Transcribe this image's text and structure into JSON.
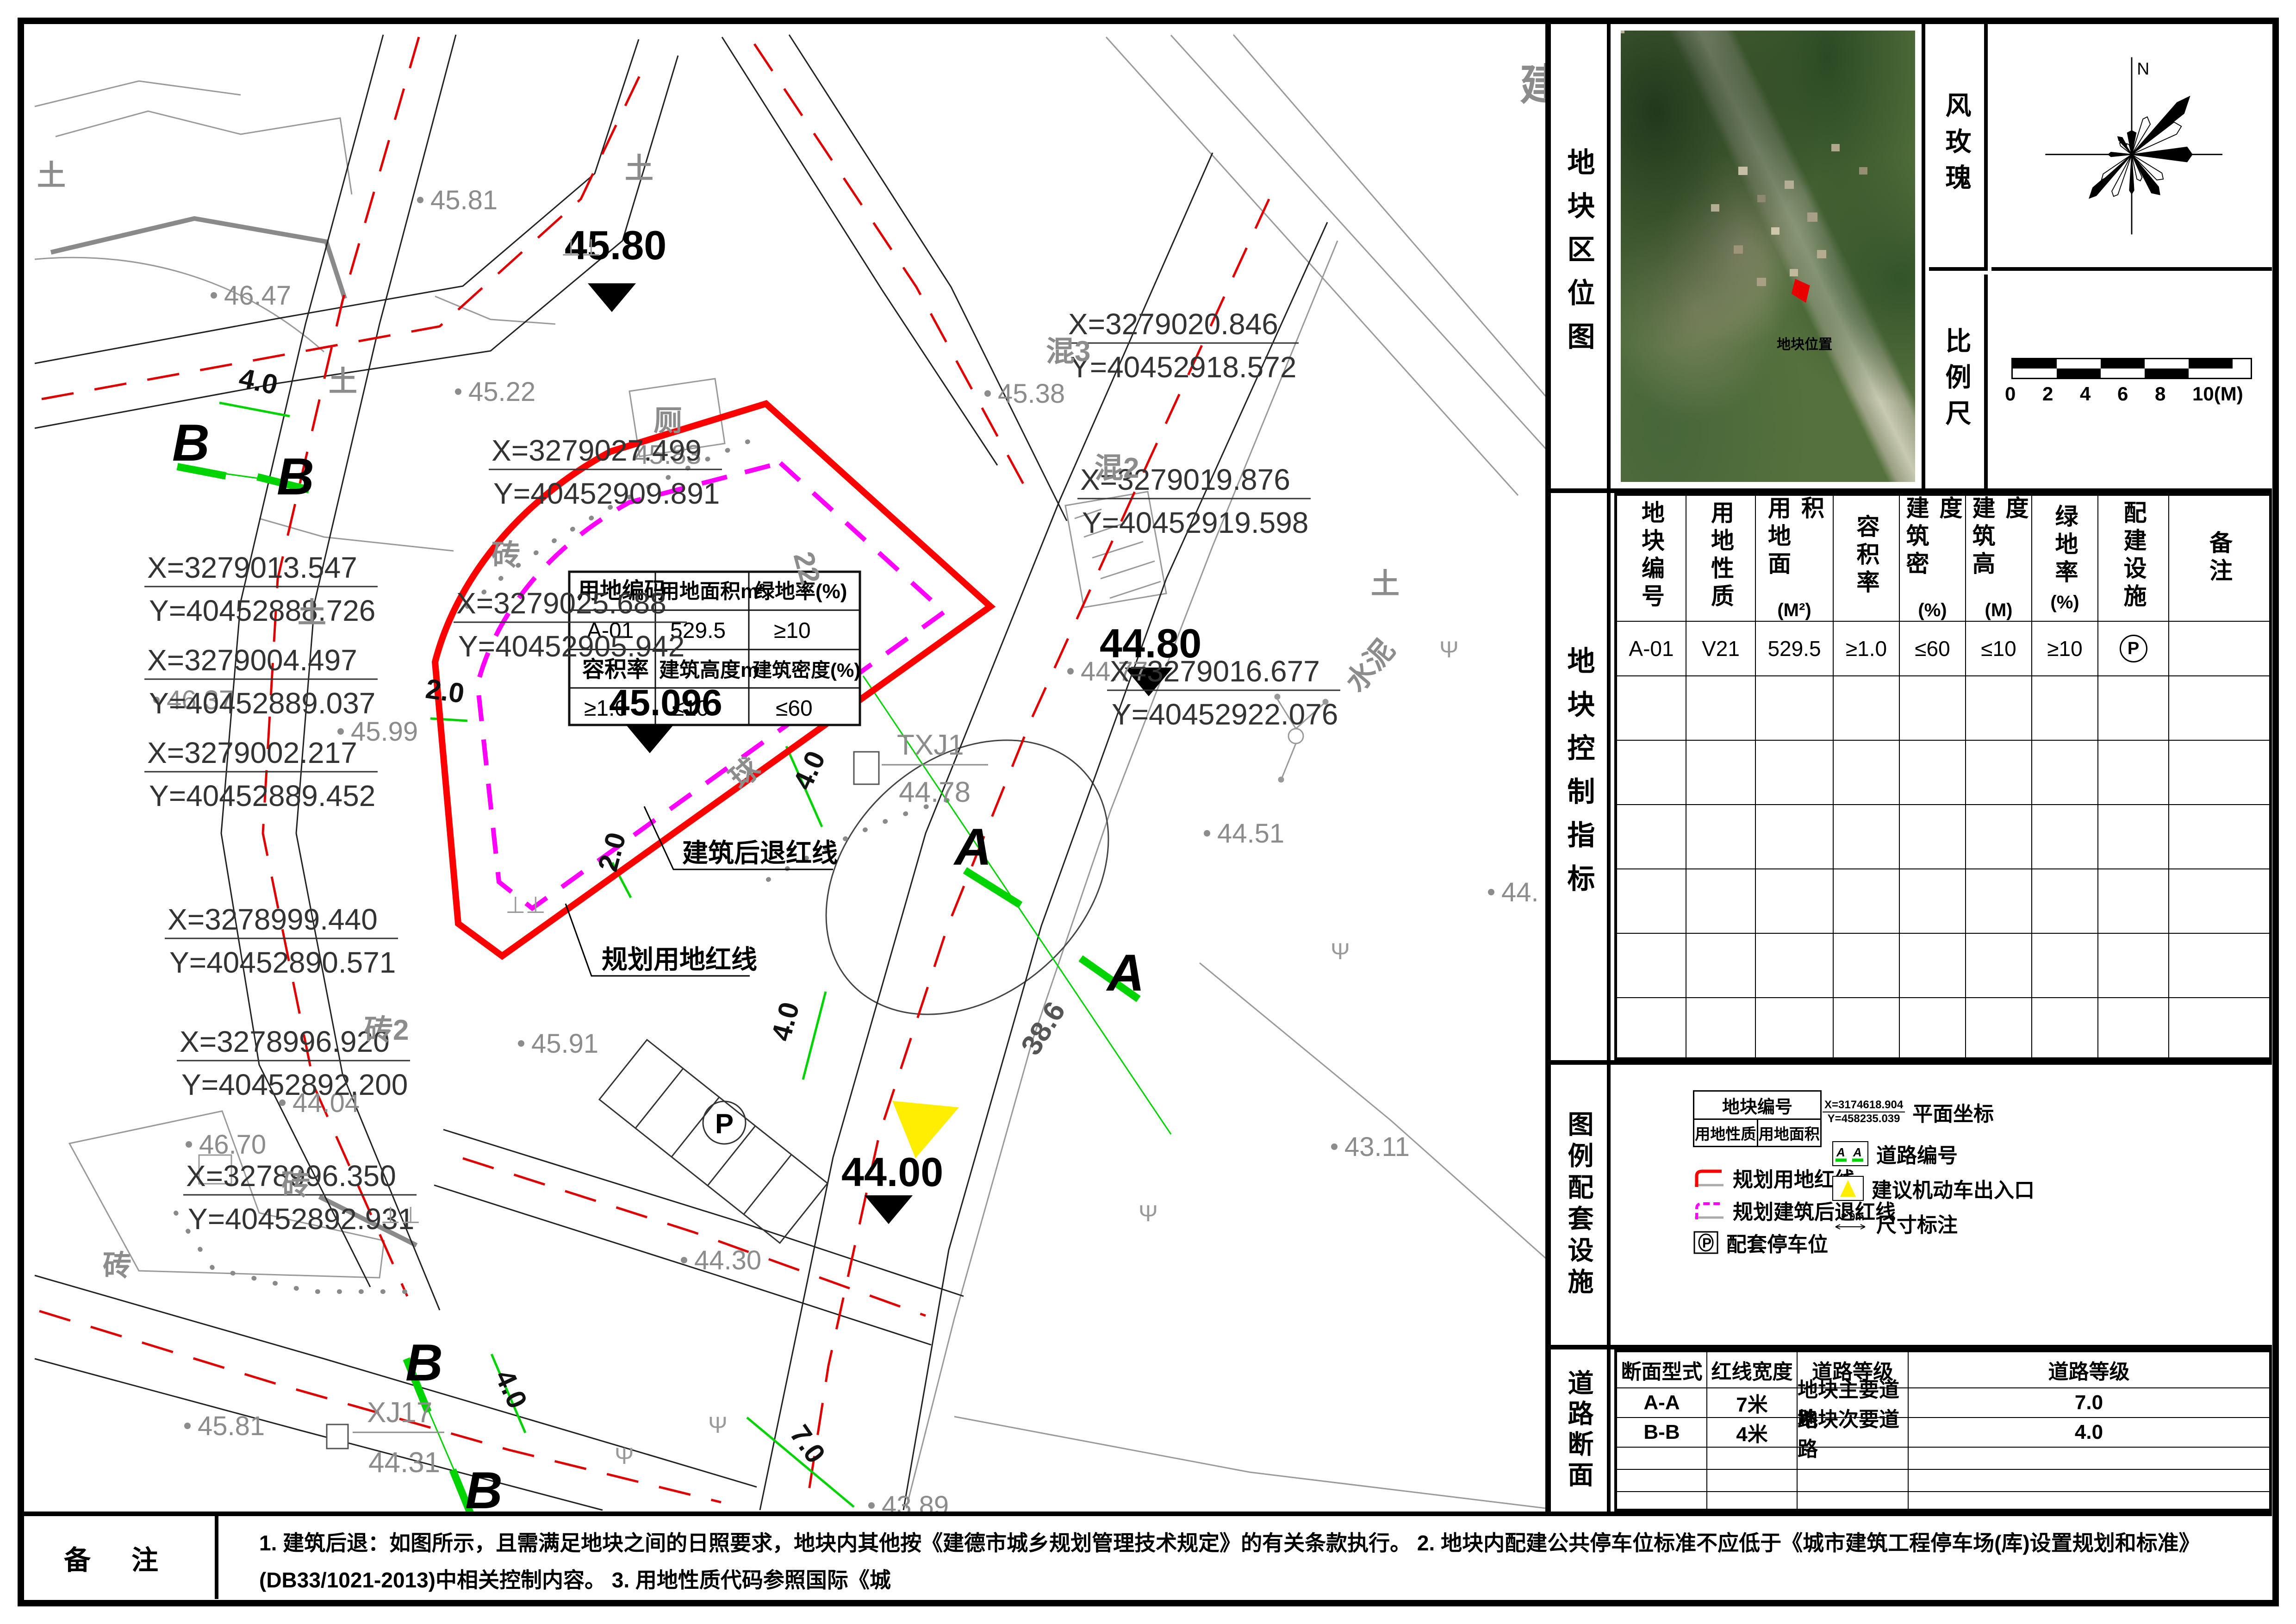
{
  "map": {
    "inner_table": {
      "r1c1": "用地编码",
      "r1c2": "用地面积m²",
      "r1c3": "绿地率(%)",
      "r2c1": "A-01",
      "r2c2": "529.5",
      "r2c3": "≥10",
      "r3c1": "容积率",
      "r3c2": "建筑高度m",
      "r3c3": "建筑密度(%)",
      "r4c1": "≥1.0",
      "r4c2": "≤10",
      "r4c3": "≤60"
    },
    "elev_markers": [
      {
        "t": "45.80"
      },
      {
        "t": "45.096"
      },
      {
        "t": "44.80"
      },
      {
        "t": "44.00"
      }
    ],
    "spots": [
      {
        "t": "45.81"
      },
      {
        "t": "46.47"
      },
      {
        "t": "45.22"
      },
      {
        "t": "45.83"
      },
      {
        "t": "45.38"
      },
      {
        "t": "46.37"
      },
      {
        "t": "45.99"
      },
      {
        "t": "45.91"
      },
      {
        "t": "46.70"
      },
      {
        "t": "44.77"
      },
      {
        "t": "44.51"
      },
      {
        "t": "44.30"
      },
      {
        "t": "44.04"
      },
      {
        "t": "43.89"
      },
      {
        "t": "43.11"
      },
      {
        "t": "45.81"
      },
      {
        "t": "44."
      }
    ],
    "coords": [
      {
        "x": "X=3279027.499",
        "y": "Y=40452909.891"
      },
      {
        "x": "X=3279025.688",
        "y": "Y=40452905.942"
      },
      {
        "x": "X=3279020.846",
        "y": "Y=40452918.572"
      },
      {
        "x": "X=3279019.876",
        "y": "Y=40452919.598"
      },
      {
        "x": "X=3279016.677",
        "y": "Y=40452922.076"
      },
      {
        "x": "X=3279013.547",
        "y": "Y=40452888.726"
      },
      {
        "x": "X=3279004.497",
        "y": "Y=40452889.037"
      },
      {
        "x": "X=3279002.217",
        "y": "Y=40452889.452"
      },
      {
        "x": "X=3278999.440",
        "y": "Y=40452890.571"
      },
      {
        "x": "X=3278996.920",
        "y": "Y=40452892.200"
      },
      {
        "x": "X=3278996.350",
        "y": "Y=40452892.931"
      }
    ],
    "labels": {
      "tu": "土",
      "zhuan": "砖",
      "zhuan2": "砖2",
      "hun3": "混3",
      "hun2": "混2",
      "shuini": "水泥",
      "ce": "厕",
      "qiu": "球",
      "n22": "22",
      "n386": "38.6",
      "jian": "建"
    },
    "dims": [
      {
        "t": "4.0"
      },
      {
        "t": "2.0"
      },
      {
        "t": "4.0"
      },
      {
        "t": "4.0"
      },
      {
        "t": "2.0"
      },
      {
        "t": "4.0"
      },
      {
        "t": "7.0"
      }
    ],
    "sections": {
      "a": "A",
      "b": "B"
    },
    "callouts": {
      "setback": "建筑后退红线",
      "redline": "规划用地红线",
      "txj1": "TXJ1",
      "txj1_elev": "44.78",
      "xj17": "XJ17",
      "xj17_elev": "44.31"
    },
    "parking_p": "P"
  },
  "panel": {
    "location_map": {
      "label": "地块区位图",
      "marker_label": "地块位置"
    },
    "wind_rose": {
      "label": "风玫瑰",
      "north": "N"
    },
    "scale_bar": {
      "label": "比例尺",
      "ticks": [
        "0",
        "2",
        "4",
        "6",
        "8",
        "10(M)"
      ]
    },
    "indicators": {
      "label": "地块控制指标",
      "columns": [
        {
          "t": "地块编号",
          "u": ""
        },
        {
          "t": "用地性质",
          "u": ""
        },
        {
          "t": "用地面积",
          "u": "(M²)"
        },
        {
          "t": "容积率",
          "u": ""
        },
        {
          "t": "建筑密度",
          "u": "(%)"
        },
        {
          "t": "建筑高度",
          "u": "(M)"
        },
        {
          "t": "绿地率",
          "u": "(%)"
        },
        {
          "t": "配建设施",
          "u": ""
        },
        {
          "t": "备注",
          "u": ""
        }
      ],
      "row": {
        "c1": "A-01",
        "c2": "V21",
        "c3": "529.5",
        "c4": "≥1.0",
        "c5": "≤60",
        "c6": "≤10",
        "c7": "≥10",
        "c8": "P",
        "c9": ""
      }
    },
    "legend": {
      "label": "图例配套设施",
      "plotbox": {
        "top": "地块编号",
        "bl": "用地性质",
        "br": "用地面积"
      },
      "red_line": "规划用地红线",
      "magenta_line": "规划建筑后退红线",
      "parking": "配套停车位",
      "parking_icon": "P",
      "coord": {
        "x": "X=3174618.904",
        "y": "Y=458235.039",
        "label": "平面坐标"
      },
      "road_no": {
        "label": "道路编号",
        "a1": "A",
        "a2": "A"
      },
      "entrance": "建议机动车出入口",
      "dim": {
        "label": "尺寸标注",
        "icon_text": "2.0m"
      }
    },
    "road_table": {
      "label": "道路断面",
      "columns": [
        "断面型式",
        "红线宽度",
        "道路等级",
        "道路等级"
      ],
      "rows": [
        {
          "c1": "A-A",
          "c2": "7米",
          "c3": "地块主要道路",
          "c4": "7.0"
        },
        {
          "c1": "B-B",
          "c2": "4米",
          "c3": "地块次要道路",
          "c4": "4.0"
        }
      ]
    }
  },
  "notes": {
    "label": "备 注",
    "line1": "1. 建筑后退：如图所示，且需满足地块之间的日照要求，地块内其他按《建德市城乡规划管理技术规定》的有关条款执行。      2. 地块内配建公共停车位标准不应低于《城市建筑工程停车场(库)设置规划和标准》(DB33/1021-2013)中相关控制内容。      3. 用地性质代码参照国际《城",
    "line2": "市用地分类与规划建设用地标准》 GB50137-2011执行。4. 图中尺寸标准单位均为米，高程系统为黄海高程系统。"
  }
}
